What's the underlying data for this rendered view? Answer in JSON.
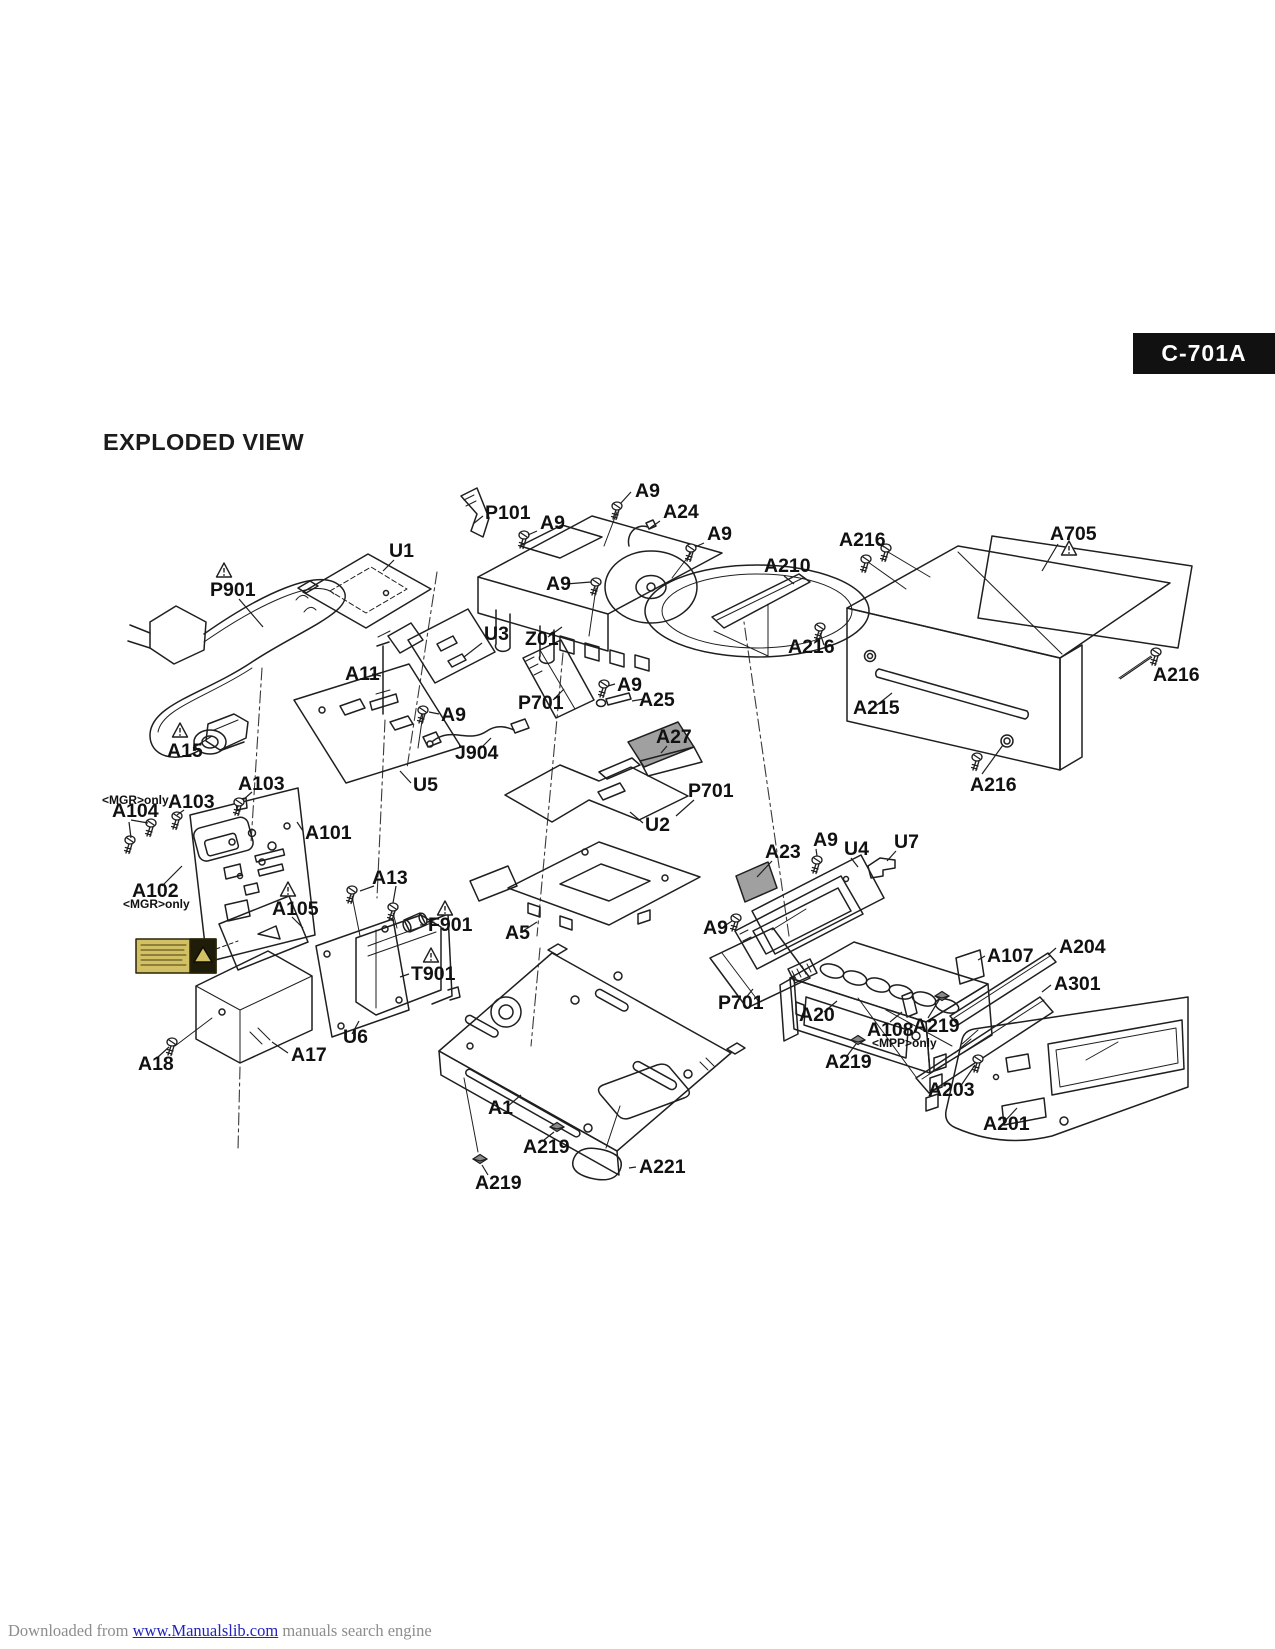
{
  "header": {
    "model": "C-701A",
    "title": "EXPLODED VIEW"
  },
  "footer": {
    "prefix": "Downloaded from ",
    "link": "www.Manualslib.com",
    "suffix": " manuals search engine"
  },
  "diagram": {
    "colors": {
      "line": "#1f1f1f",
      "label_text": "#111111",
      "badge_bg": "#111111",
      "badge_text": "#ffffff",
      "part_shade": "#a0a0a0",
      "caution_yellow": "#d2c164",
      "caution_dark": "#201c0a",
      "footer_text": "#8d8d8d",
      "footer_link": "#2323bb"
    },
    "labels": [
      {
        "t": "A9",
        "x": 635,
        "y": 497,
        "ld": [
          [
            631,
            492,
            621,
            503
          ]
        ]
      },
      {
        "t": "P101",
        "x": 485,
        "y": 519,
        "ld": [
          [
            483,
            516,
            473,
            524
          ]
        ]
      },
      {
        "t": "A9",
        "x": 540,
        "y": 529,
        "ld": [
          [
            537,
            531,
            528,
            535
          ]
        ]
      },
      {
        "t": "A24",
        "x": 663,
        "y": 518,
        "ld": [
          [
            660,
            521,
            650,
            528
          ]
        ]
      },
      {
        "t": "A9",
        "x": 707,
        "y": 540,
        "ld": [
          [
            704,
            543,
            695,
            547
          ]
        ]
      },
      {
        "t": "A9",
        "x": 546,
        "y": 590,
        "ld": [
          [
            566,
            584,
            591,
            582
          ]
        ]
      },
      {
        "t": "Z01",
        "x": 525,
        "y": 645,
        "ld": [
          [
            548,
            637,
            562,
            627
          ]
        ]
      },
      {
        "t": "U3",
        "x": 484,
        "y": 640,
        "ld": [
          [
            482,
            643,
            464,
            657
          ]
        ]
      },
      {
        "t": "U1",
        "x": 389,
        "y": 557,
        "ld": [
          [
            394,
            560,
            383,
            571
          ]
        ]
      },
      {
        "t": "P901",
        "x": 210,
        "y": 596,
        "ld": [
          [
            239,
            599,
            263,
            627
          ]
        ]
      },
      {
        "t": "A15",
        "x": 167,
        "y": 757,
        "ld": [
          [
            193,
            748,
            212,
            736
          ]
        ]
      },
      {
        "t": "A11",
        "x": 345,
        "y": 680,
        "ld": [
          [
            372,
            674,
            381,
            676
          ]
        ]
      },
      {
        "t": "A9",
        "x": 441,
        "y": 721,
        "ld": [
          [
            439,
            714,
            429,
            712
          ]
        ]
      },
      {
        "t": "J904",
        "x": 455,
        "y": 759,
        "ld": [
          [
            479,
            750,
            491,
            738
          ]
        ]
      },
      {
        "t": "U5",
        "x": 413,
        "y": 791,
        "ld": [
          [
            411,
            783,
            400,
            771
          ]
        ]
      },
      {
        "t": "P701",
        "x": 518,
        "y": 709,
        "ld": [
          [
            553,
            700,
            564,
            689
          ]
        ]
      },
      {
        "t": "A9",
        "x": 617,
        "y": 691,
        "ld": [
          [
            615,
            684,
            608,
            686
          ]
        ]
      },
      {
        "t": "A25",
        "x": 639,
        "y": 706,
        "ld": [
          [
            644,
            699,
            632,
            701
          ]
        ]
      },
      {
        "t": "A27",
        "x": 656,
        "y": 743,
        "ld": [
          [
            667,
            746,
            661,
            753
          ]
        ]
      },
      {
        "t": "P701",
        "x": 688,
        "y": 797,
        "ld": [
          [
            694,
            800,
            676,
            816
          ]
        ]
      },
      {
        "t": "U2",
        "x": 645,
        "y": 831,
        "ld": [
          [
            643,
            823,
            630,
            812
          ]
        ]
      },
      {
        "t": "A216",
        "x": 839,
        "y": 546,
        "ld": [
          [
            876,
            541,
            884,
            547
          ]
        ]
      },
      {
        "t": "A705",
        "x": 1050,
        "y": 540,
        "ld": [
          [
            1058,
            544,
            1042,
            571
          ]
        ]
      },
      {
        "t": "A210",
        "x": 764,
        "y": 572,
        "ld": [
          [
            784,
            576,
            794,
            584
          ]
        ]
      },
      {
        "t": "A216",
        "x": 788,
        "y": 653,
        "ld": [
          [
            824,
            645,
            820,
            633
          ]
        ]
      },
      {
        "t": "A215",
        "x": 853,
        "y": 714,
        "ld": [
          [
            877,
            705,
            892,
            693
          ]
        ]
      },
      {
        "t": "A216",
        "x": 1153,
        "y": 681,
        "ld": [
          [
            1152,
            657,
            1120,
            679
          ]
        ]
      },
      {
        "t": "A216",
        "x": 970,
        "y": 791,
        "ld": [
          [
            982,
            774,
            1003,
            745
          ]
        ]
      },
      {
        "t": "<MGR>only",
        "x": 102,
        "y": 804,
        "sm": true
      },
      {
        "t": "A104",
        "x": 112,
        "y": 817,
        "ld": [
          [
            131,
            820,
            148,
            823
          ],
          [
            129,
            822,
            131,
            838
          ]
        ]
      },
      {
        "t": "A103",
        "x": 168,
        "y": 808,
        "ld": [
          [
            184,
            810,
            177,
            815
          ]
        ]
      },
      {
        "t": "A103",
        "x": 238,
        "y": 790,
        "ld": [
          [
            252,
            792,
            243,
            800
          ]
        ]
      },
      {
        "t": "A101",
        "x": 305,
        "y": 839,
        "ld": [
          [
            303,
            831,
            297,
            822
          ]
        ]
      },
      {
        "t": "A102",
        "x": 132,
        "y": 897,
        "ld": [
          [
            162,
            886,
            182,
            866
          ]
        ]
      },
      {
        "t": "<MGR>only",
        "x": 123,
        "y": 908,
        "sm": true
      },
      {
        "t": "A105",
        "x": 272,
        "y": 915,
        "ld": [
          [
            292,
            917,
            303,
            928
          ]
        ]
      },
      {
        "t": "A13",
        "x": 372,
        "y": 884,
        "ld": [
          [
            374,
            886,
            360,
            891
          ],
          [
            396,
            886,
            393,
            903
          ]
        ]
      },
      {
        "t": "F901",
        "x": 428,
        "y": 931,
        "ld": [
          [
            426,
            925,
            420,
            925
          ]
        ]
      },
      {
        "t": "T901",
        "x": 411,
        "y": 980,
        "ld": [
          [
            409,
            974,
            400,
            977
          ]
        ]
      },
      {
        "t": "U6",
        "x": 343,
        "y": 1043,
        "ld": [
          [
            352,
            1034,
            359,
            1021
          ]
        ]
      },
      {
        "t": "A17",
        "x": 291,
        "y": 1061,
        "ld": [
          [
            288,
            1053,
            272,
            1042
          ]
        ]
      },
      {
        "t": "A18",
        "x": 138,
        "y": 1070,
        "ld": [
          [
            158,
            1057,
            169,
            1047
          ]
        ]
      },
      {
        "t": "A5",
        "x": 505,
        "y": 939,
        "ld": [
          [
            523,
            931,
            537,
            922
          ]
        ]
      },
      {
        "t": "A1",
        "x": 488,
        "y": 1114,
        "ld": [
          [
            508,
            1106,
            521,
            1095
          ]
        ]
      },
      {
        "t": "A219",
        "x": 523,
        "y": 1153,
        "ld": [
          [
            544,
            1140,
            554,
            1132
          ]
        ]
      },
      {
        "t": "A219",
        "x": 475,
        "y": 1189,
        "ld": [
          [
            488,
            1175,
            482,
            1165
          ]
        ]
      },
      {
        "t": "A221",
        "x": 639,
        "y": 1173,
        "ld": [
          [
            636,
            1167,
            629,
            1168
          ]
        ]
      },
      {
        "t": "A23",
        "x": 765,
        "y": 858,
        "ld": [
          [
            772,
            861,
            757,
            877
          ]
        ]
      },
      {
        "t": "A9",
        "x": 813,
        "y": 846,
        "ld": [
          [
            816,
            849,
            817,
            856
          ]
        ]
      },
      {
        "t": "U4",
        "x": 844,
        "y": 855,
        "ld": [
          [
            851,
            858,
            858,
            867
          ]
        ]
      },
      {
        "t": "U7",
        "x": 894,
        "y": 848,
        "ld": [
          [
            896,
            851,
            887,
            861
          ]
        ]
      },
      {
        "t": "A9",
        "x": 703,
        "y": 934,
        "ld": [
          [
            723,
            927,
            732,
            921
          ]
        ]
      },
      {
        "t": "P701",
        "x": 718,
        "y": 1009,
        "ld": [
          [
            744,
            1000,
            753,
            989
          ]
        ]
      },
      {
        "t": "A20",
        "x": 799,
        "y": 1021,
        "ld": [
          [
            824,
            1012,
            837,
            1001
          ]
        ]
      },
      {
        "t": "A107",
        "x": 987,
        "y": 962,
        "ld": [
          [
            985,
            956,
            978,
            960
          ]
        ]
      },
      {
        "t": "A204",
        "x": 1059,
        "y": 953,
        "ld": [
          [
            1056,
            948,
            1048,
            955
          ]
        ]
      },
      {
        "t": "A301",
        "x": 1054,
        "y": 990,
        "ld": [
          [
            1051,
            985,
            1042,
            992
          ]
        ]
      },
      {
        "t": "A108",
        "x": 867,
        "y": 1036,
        "ld": [
          [
            890,
            1022,
            902,
            1012
          ]
        ]
      },
      {
        "t": "<MPP>only",
        "x": 872,
        "y": 1047,
        "sm": true
      },
      {
        "t": "A219",
        "x": 913,
        "y": 1032,
        "ld": [
          [
            928,
            1018,
            939,
            1000
          ]
        ]
      },
      {
        "t": "A219",
        "x": 825,
        "y": 1068,
        "ld": [
          [
            847,
            1056,
            856,
            1044
          ]
        ]
      },
      {
        "t": "A203",
        "x": 928,
        "y": 1096,
        "ld": [
          [
            960,
            1087,
            975,
            1065
          ]
        ]
      },
      {
        "t": "A201",
        "x": 983,
        "y": 1130,
        "ld": [
          [
            1005,
            1121,
            1017,
            1108
          ]
        ]
      }
    ],
    "screws": [
      [
        617,
        506
      ],
      [
        524,
        535
      ],
      [
        691,
        548
      ],
      [
        596,
        582
      ],
      [
        423,
        710
      ],
      [
        604,
        684
      ],
      [
        886,
        548
      ],
      [
        866,
        559
      ],
      [
        820,
        627
      ],
      [
        1156,
        652
      ],
      [
        977,
        757
      ],
      [
        817,
        860
      ],
      [
        736,
        918
      ],
      [
        352,
        890
      ],
      [
        393,
        907
      ],
      [
        172,
        1042
      ],
      [
        978,
        1059
      ],
      [
        151,
        823
      ],
      [
        130,
        840
      ],
      [
        177,
        816
      ],
      [
        239,
        802
      ]
    ],
    "clips": [
      [
        557,
        1127
      ],
      [
        480,
        1159
      ],
      [
        858,
        1040
      ],
      [
        942,
        996
      ]
    ],
    "warning_triangles": [
      [
        224,
        571
      ],
      [
        180,
        731
      ],
      [
        1069,
        549
      ],
      [
        288,
        890
      ],
      [
        445,
        909
      ],
      [
        431,
        956
      ]
    ]
  }
}
